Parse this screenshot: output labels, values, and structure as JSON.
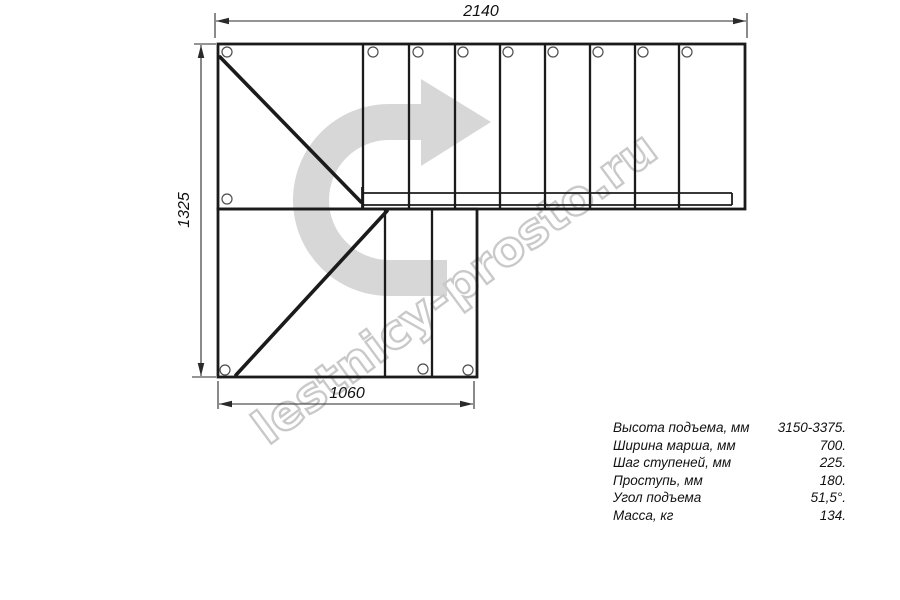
{
  "colors": {
    "line": "#1b1b1b",
    "dim": "#2a2a2a",
    "arrow": "#d7d7d7",
    "watermark": "#c9c9c9"
  },
  "watermark": {
    "text": "lestnicy-prosto.ru"
  },
  "dimensions": {
    "top_width": "2140",
    "left_height": "1325",
    "bottom_width": "1060"
  },
  "specs": {
    "rows": [
      {
        "label": "Высота подъема, мм",
        "value": "3150-3375."
      },
      {
        "label": "Ширина марша, мм",
        "value": "700."
      },
      {
        "label": "Шаг ступеней, мм",
        "value": "225."
      },
      {
        "label": "Проступь, мм",
        "value": "180."
      },
      {
        "label": "Угол подъема",
        "value": "51,5°."
      },
      {
        "label": "Масса, кг",
        "value": "134."
      }
    ]
  }
}
